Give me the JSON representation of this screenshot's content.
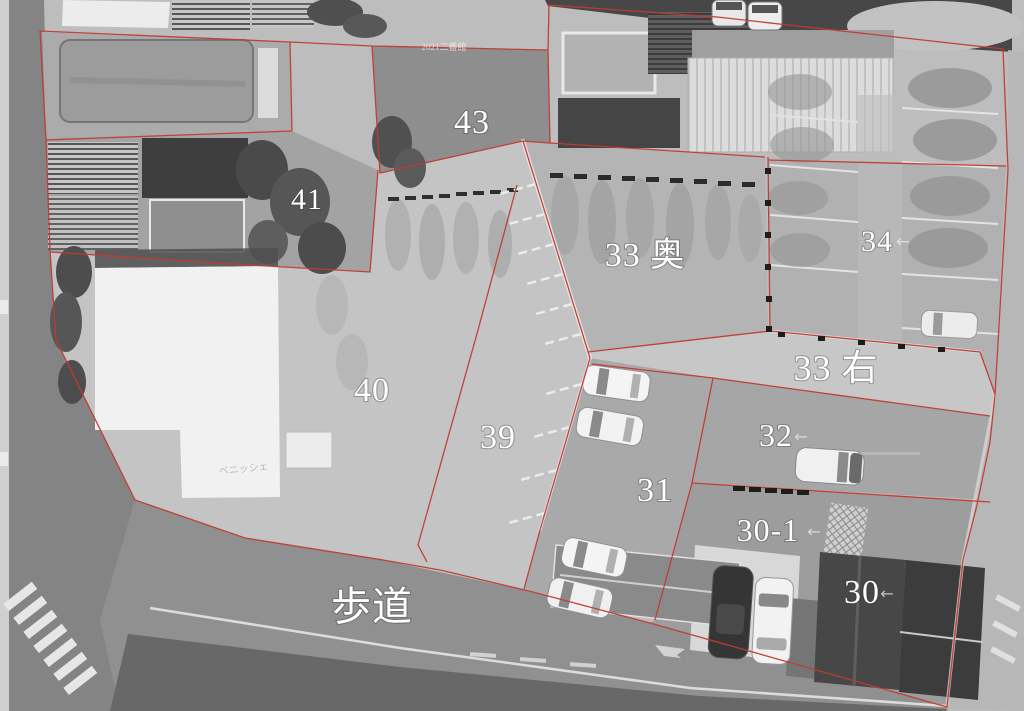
{
  "map": {
    "description": "grayscale aerial photo with red parcel boundaries",
    "boundary_color": "#c23b31",
    "label_color": "#ffffff",
    "arrow_glyph": "←",
    "parcels": [
      {
        "id": "43",
        "label": "43"
      },
      {
        "id": "41",
        "label": "41"
      },
      {
        "id": "40",
        "label": "40"
      },
      {
        "id": "39",
        "label": "39"
      },
      {
        "id": "33-oku",
        "label": "33 奥"
      },
      {
        "id": "34",
        "label": "34"
      },
      {
        "id": "33-migi",
        "label": "33 右"
      },
      {
        "id": "32",
        "label": "32"
      },
      {
        "id": "31",
        "label": "31"
      },
      {
        "id": "30-1",
        "label": "30-1"
      },
      {
        "id": "30",
        "label": "30"
      }
    ],
    "sidewalk_label": "歩道",
    "watermarks": {
      "top": "2021二番館",
      "mid": "ベニッシェ"
    }
  }
}
